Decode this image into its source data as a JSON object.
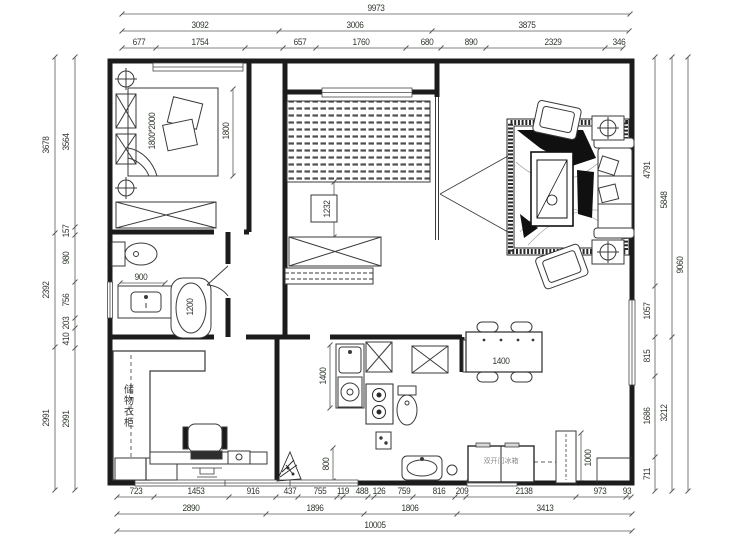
{
  "dims": {
    "top1": [
      "9973"
    ],
    "top2": [
      "3092",
      "3006",
      "3875"
    ],
    "top3": [
      "677",
      "1754",
      "657",
      "1760",
      "680",
      "890",
      "2329",
      "346"
    ],
    "bottom1": [
      "723",
      "1453",
      "916",
      "437",
      "755",
      "119",
      "488",
      "126",
      "759",
      "816",
      "209",
      "2138",
      "973",
      "93"
    ],
    "bottom2": [
      "2890",
      "1896",
      "1806",
      "3413"
    ],
    "bottom3": [
      "10005"
    ],
    "left_outer": [
      "3678",
      "2392",
      "2991"
    ],
    "left_inner": [
      "3564",
      "157",
      "980",
      "756",
      "203",
      "410",
      "2991"
    ],
    "right_inner": [
      "4791",
      "1057",
      "815",
      "1686",
      "711"
    ],
    "right_mid": [
      "5848",
      "3212"
    ],
    "right_outer": [
      "9060"
    ]
  },
  "interior": {
    "bed_size": "1800*2000",
    "bed_width": "1800",
    "tv_wall": "1232",
    "vanity": "900",
    "bathtub": "1200",
    "closet": "储物衣柜",
    "counter": "1400",
    "cabinet": "800",
    "dining_table": "1400",
    "fridge": "双开门冰箱",
    "fridge_width": "1000"
  },
  "colors": {
    "wall": "#1c1c1c",
    "furniture": "#3a3a3a",
    "dim_line": "#5a5a5a",
    "dim_text": "#30382e",
    "bg": "#ffffff"
  }
}
